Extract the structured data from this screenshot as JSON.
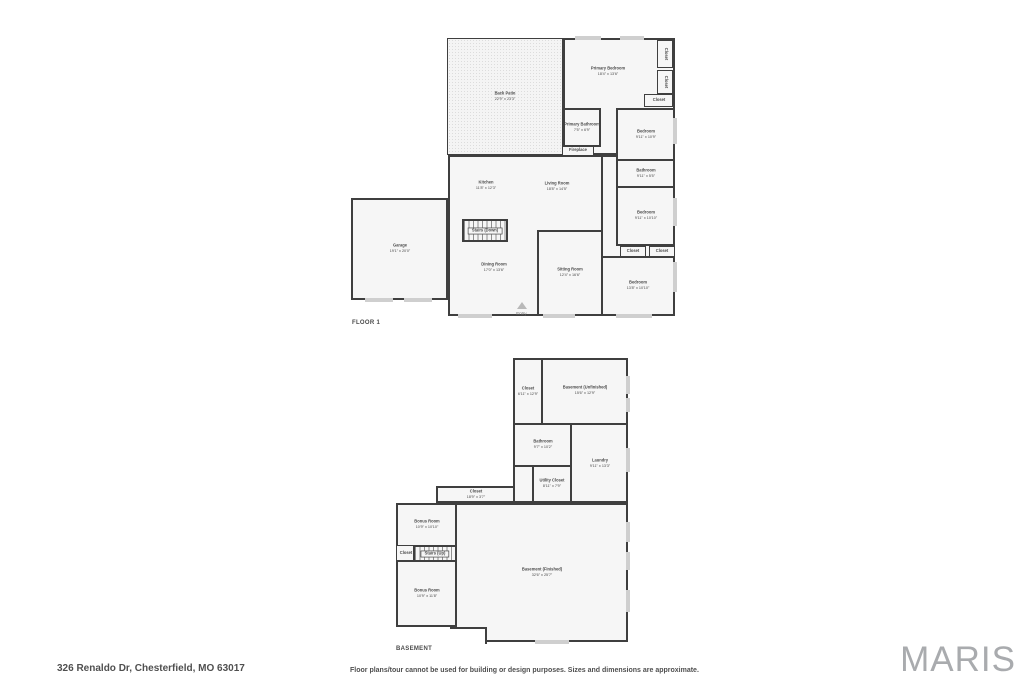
{
  "floor1": {
    "label": "FLOOR 1",
    "rooms": {
      "back_patio": {
        "name": "Back Patio",
        "dims": "22'9\" x 23'3\""
      },
      "primary_bedroom": {
        "name": "Primary Bedroom",
        "dims": "18'4\" x 13'6\""
      },
      "closet_tr1": {
        "name": "Closet"
      },
      "closet_tr2": {
        "name": "Closet"
      },
      "closet_tr3": {
        "name": "Closet"
      },
      "primary_bathroom": {
        "name": "Primary Bathroom",
        "dims": "7'5\" x 6'9\""
      },
      "fireplace": {
        "name": "Fireplace"
      },
      "bedroom_top_right": {
        "name": "Bedroom",
        "dims": "9'11\" x 10'9\""
      },
      "bathroom_right": {
        "name": "Bathroom",
        "dims": "9'11\" x 5'5\""
      },
      "bedroom_right": {
        "name": "Bedroom",
        "dims": "9'11\" x 10'10\""
      },
      "kitchen": {
        "name": "Kitchen",
        "dims": "11'8\" x 12'3\""
      },
      "living_room": {
        "name": "Living Room",
        "dims": "18'8\" x 14'5\""
      },
      "stairs_down": {
        "name": "Stairs (Down)"
      },
      "garage": {
        "name": "Garage",
        "dims": "19'1\" x 20'0\""
      },
      "dining_room": {
        "name": "Dining Room",
        "dims": "17'0\" x 13'6\""
      },
      "sitting_room": {
        "name": "Sitting Room",
        "dims": "12'4\" x 16'6\""
      },
      "closet_hall1": {
        "name": "Closet",
        "dims": "4'10\" x 1'10\""
      },
      "closet_hall2": {
        "name": "Closet",
        "dims": "4'6\" x 1'10\""
      },
      "bedroom_bottom_right": {
        "name": "Bedroom",
        "dims": "13'8\" x 10'10\""
      },
      "entry": {
        "name": "Entry"
      }
    }
  },
  "basement": {
    "label": "BASEMENT",
    "rooms": {
      "closet_top": {
        "name": "Closet",
        "dims": "6'11\" x 12'9\""
      },
      "basement_unfinished": {
        "name": "Basement (Unfinished)",
        "dims": "15'6\" x 12'9\""
      },
      "bathroom": {
        "name": "Bathroom",
        "dims": "9'7\" x 10'2\""
      },
      "laundry": {
        "name": "Laundry",
        "dims": "9'11\" x 13'3\""
      },
      "utility_closet": {
        "name": "Utility Closet",
        "dims": "8'11\" x 7'9\""
      },
      "closet_long": {
        "name": "Closet",
        "dims": "18'9\" x 3'7\""
      },
      "bonus_room_1": {
        "name": "Bonus Room",
        "dims": "10'9\" x 10'10\""
      },
      "closet_small": {
        "name": "Closet"
      },
      "stairs_up": {
        "name": "Stairs (Up)"
      },
      "bonus_room_2": {
        "name": "Bonus Room",
        "dims": "10'9\" x 11'8\""
      },
      "basement_finished": {
        "name": "Basement (Finished)",
        "dims": "32'6\" x 25'7\""
      }
    }
  },
  "footer": {
    "address": "326 Renaldo Dr, Chesterfield, MO 63017",
    "disclaimer": "Floor plans/tour cannot be used for building or design purposes. Sizes and dimensions are approximate.",
    "logo": "MARIS"
  },
  "colors": {
    "wall": "#3f3f3f",
    "room_fill": "#f6f6f6",
    "window": "#cfcfcf",
    "label": "#4a4a4a",
    "logo": "#a9abae"
  }
}
